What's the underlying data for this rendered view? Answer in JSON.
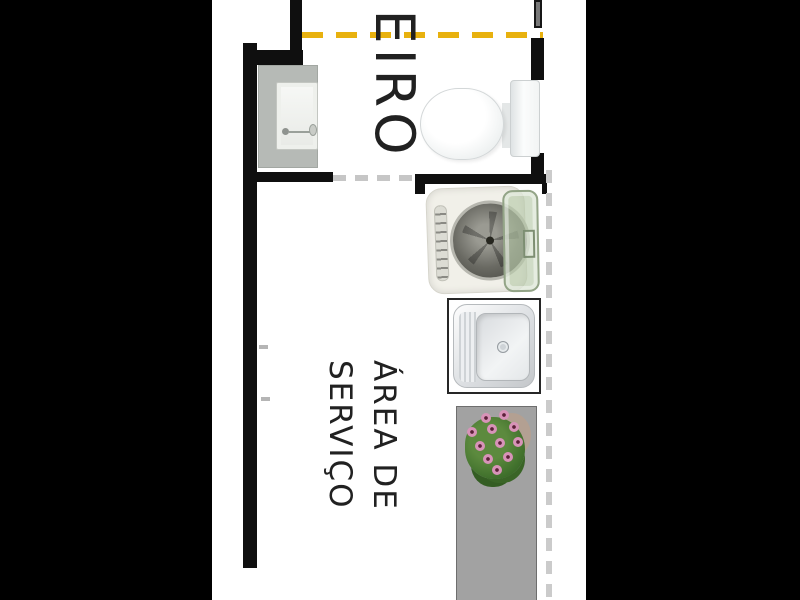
{
  "document": {
    "type": "apartment-floor-plan-crop",
    "orientation_note": "room labels rotated 90 degrees clockwise"
  },
  "rooms": {
    "bathroom": {
      "label_visible": "HEIRO"
    },
    "service_area": {
      "label_lines": [
        "ÁREA DE",
        "SERVIÇO"
      ]
    }
  },
  "fixtures": [
    {
      "name": "vanity-sink",
      "room": "bathroom"
    },
    {
      "name": "toilet",
      "room": "bathroom"
    },
    {
      "name": "washing-machine",
      "room": "service-area"
    },
    {
      "name": "laundry-tank",
      "room": "service-area"
    },
    {
      "name": "potted-plant",
      "room": "service-area"
    },
    {
      "name": "floor-mat",
      "room": "service-area"
    }
  ],
  "lines": {
    "yellow_dashed_boundary": "bathroom top boundary",
    "gray_dashed_divider": "bathroom / service area divider",
    "gray_dashed_open_side": "service area open right side"
  },
  "colors": {
    "background": "#000000",
    "wall": "#0f0f0f",
    "plan_bg": "#ffffff",
    "boundary_dash_yellow": "#e8b10e",
    "divider_dash_gray": "#c6c6c6",
    "open_side_dash": "#cbcbcb",
    "floor_mat": "#a2a2a2",
    "washer_lid": "#b9c9ab",
    "flower_pink": "#d893b8",
    "label_text": "#212121"
  }
}
